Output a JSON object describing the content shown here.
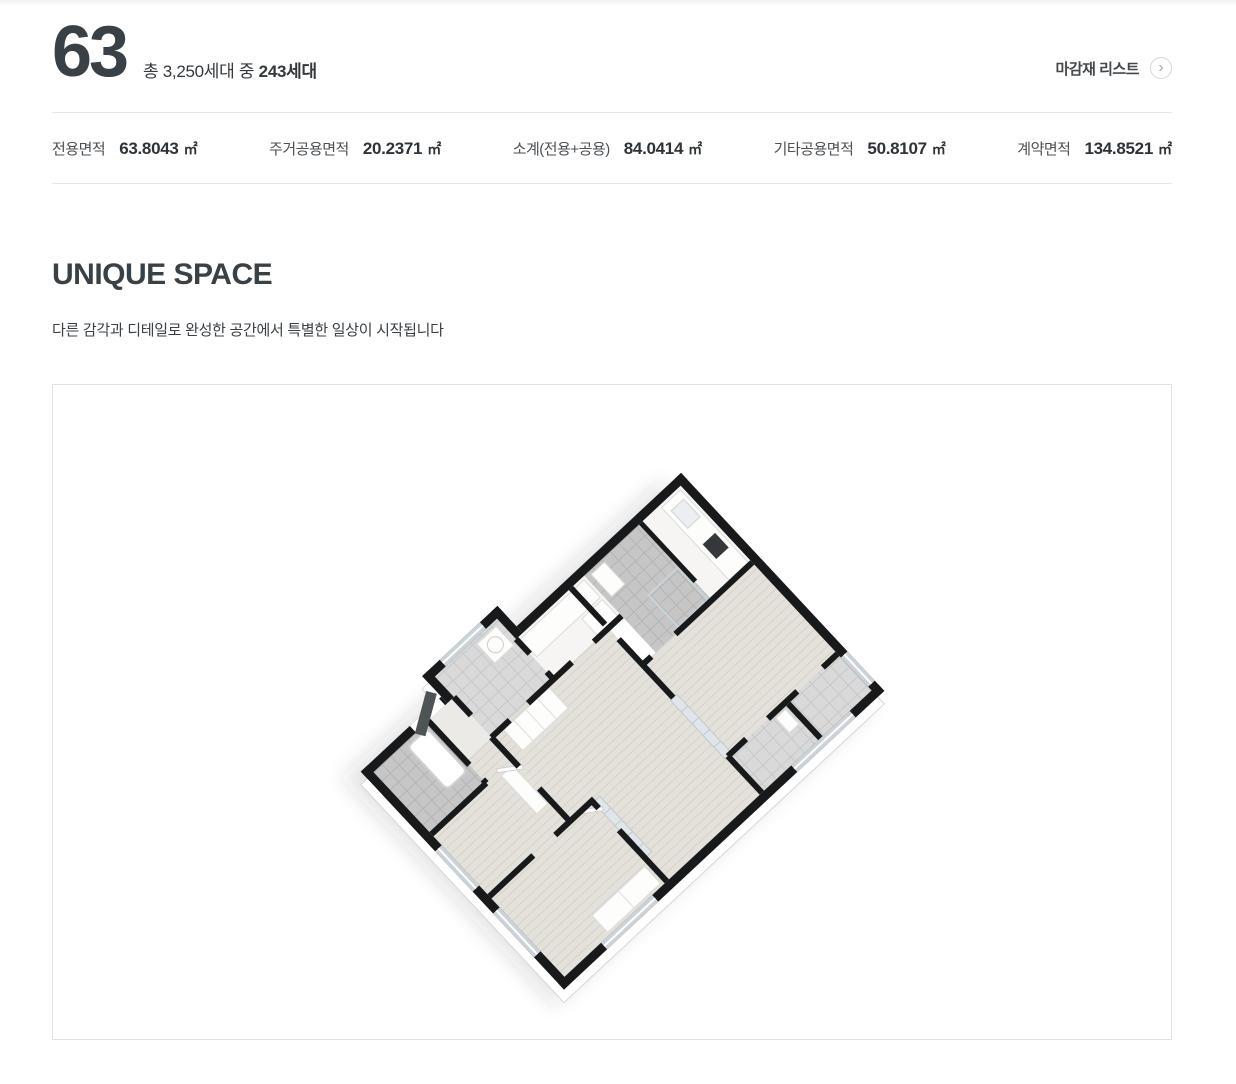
{
  "header": {
    "unit_number": "63",
    "household_prefix": "총 3,250세대 중 ",
    "household_bold": "243세대",
    "finish_list_label": "마감재 리스트",
    "chevron_icon": "›"
  },
  "specs": [
    {
      "label": "전용면적",
      "value": "63.8043",
      "unit": "㎡"
    },
    {
      "label": "주거공용면적",
      "value": "20.2371",
      "unit": "㎡"
    },
    {
      "label": "소계(전용+공용)",
      "value": "84.0414",
      "unit": "㎡"
    },
    {
      "label": "기타공용면적",
      "value": "50.8107",
      "unit": "㎡"
    },
    {
      "label": "계약면적",
      "value": "134.8521",
      "unit": "㎡"
    }
  ],
  "section": {
    "title": "UNIQUE SPACE",
    "subtitle": "다른 감각과 디테일로 완성한 공간에서 특별한 일상이 시작됩니다"
  },
  "floorplan": {
    "name": "isometric-3d-floorplan"
  },
  "colors": {
    "text_dark": "#343b40",
    "text": "#4b5156",
    "value": "#2d3338",
    "divider": "#e7e7e7",
    "box_border": "#e2e2e2",
    "wall": "#17191b",
    "wood": "#e4e1db",
    "wood_line": "#d7d2ca",
    "tile": "#d9d9d9",
    "tile_line": "#c8c8c8",
    "tile_dark": "#c6c6c6",
    "tile_dark_line": "#b4b4b4",
    "surface": "#f6f5f3",
    "glass": "#dfe5e8",
    "accent_door": "#4e5356"
  }
}
